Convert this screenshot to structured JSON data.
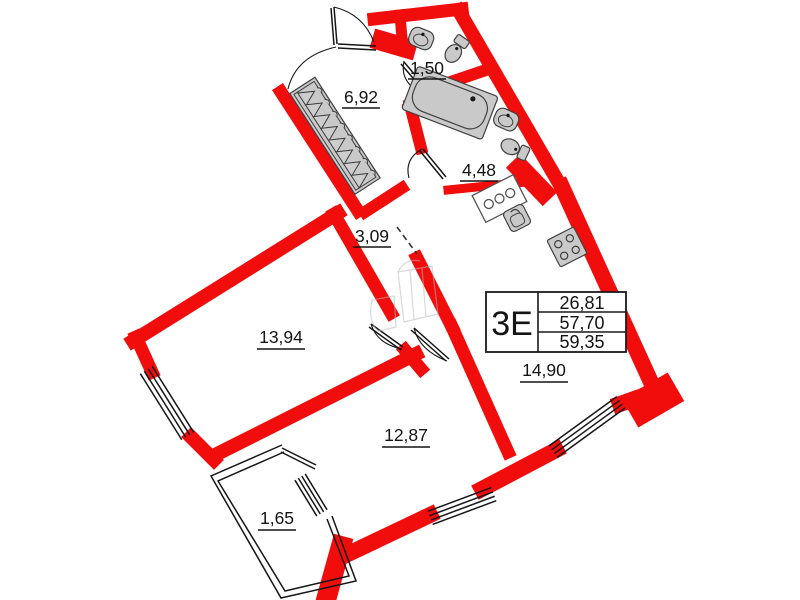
{
  "unit_card": {
    "type_label": "3Е",
    "areas": [
      "26,81",
      "57,70",
      "59,35"
    ]
  },
  "rooms": {
    "wc": "1,50",
    "wardrobe": "6,92",
    "bathroom": "4,48",
    "hall": "3,09",
    "bedroom": "13,94",
    "living": "12,87",
    "kitchen_living": "14,90",
    "balcony": "1,65"
  },
  "colors": {
    "wall_red": "#f20d0d",
    "fixture_gray": "#c9c9c9",
    "line_black": "#161616"
  },
  "icons": {
    "bathtub": "bathtub-icon",
    "sink": "sink-icon",
    "toilet": "toilet-icon",
    "stove": "stove-icon",
    "kitchen_sink": "kitchen-sink-icon",
    "appliance": "appliance-icon",
    "hanger": "hanger-icon"
  }
}
